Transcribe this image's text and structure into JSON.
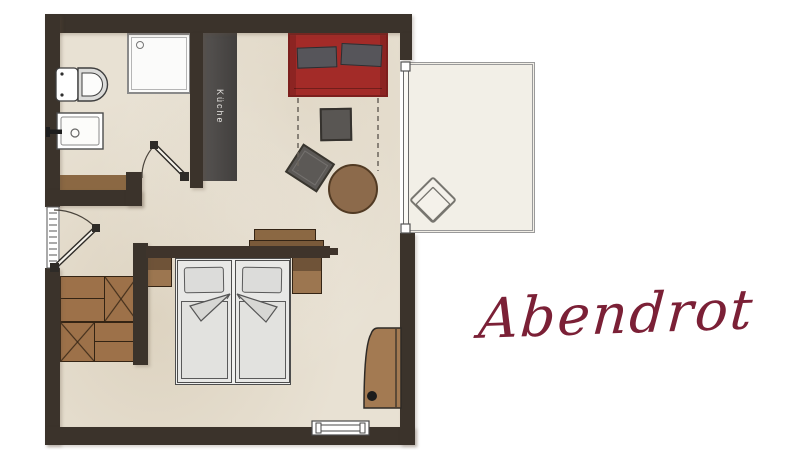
{
  "title": {
    "text": "Abendrot"
  },
  "plan": {
    "kitchen_label": "Küche"
  },
  "palette": {
    "background": "#ffffff",
    "wall": "#3b332b",
    "floor": "#e8e1d3",
    "kitchen_block": "#4b4846",
    "kitchen_label_color": "#e5e3e0",
    "wood": "#9d7149",
    "wood_line": "#342414",
    "sofa_red": "#a32b28",
    "sofa_red_dark": "#7c1f1d",
    "cushion_gray": "#56555a",
    "table_gray": "#595653",
    "round_table_brown": "#8c6a4b",
    "bed_white": "#e8e8e6",
    "bed_line": "#4d4d4d",
    "balcony_floor": "#f2efe7",
    "balcony_line": "#9a9a9a",
    "fixture_line": "#3e3e3e",
    "title_color": "#7b2036"
  }
}
